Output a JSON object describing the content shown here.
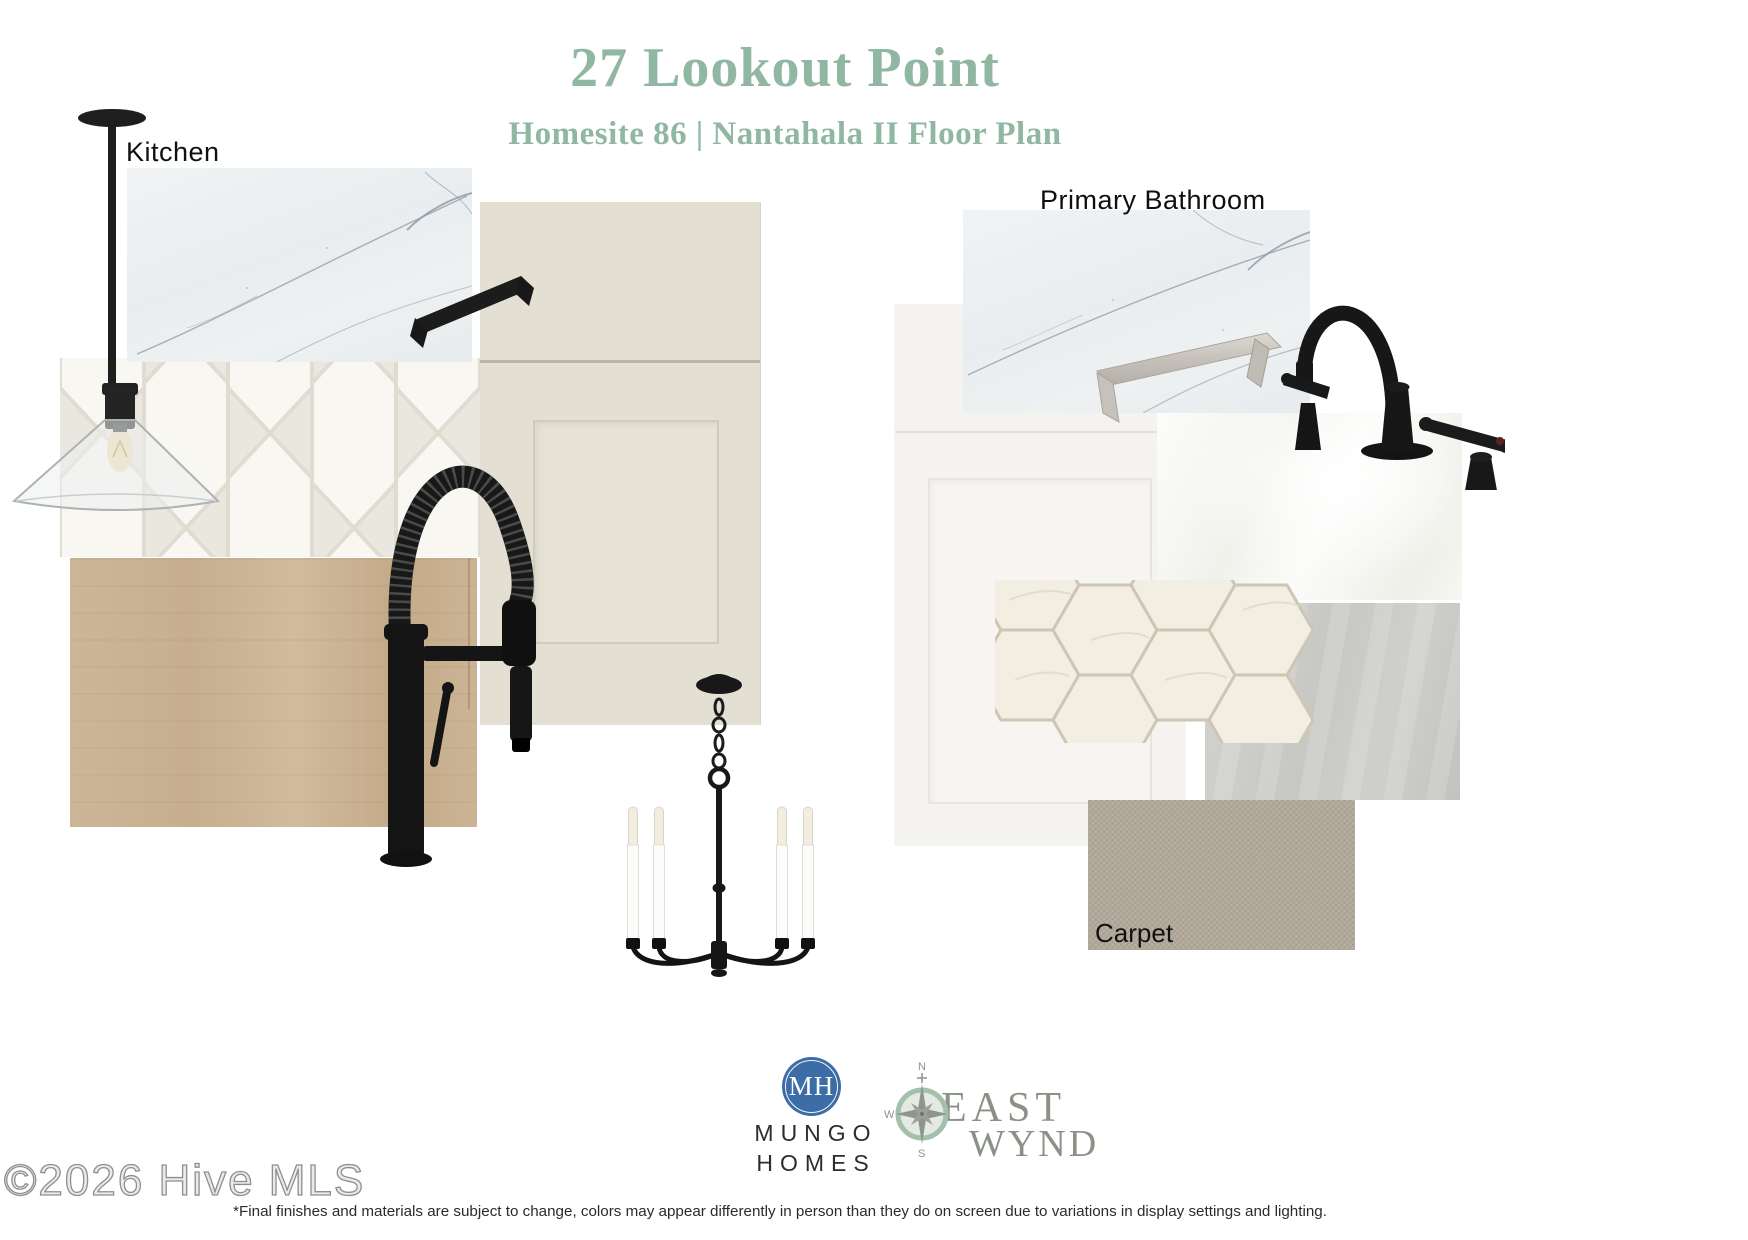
{
  "page": {
    "background": "#ffffff"
  },
  "header": {
    "title": "27 Lookout Point",
    "subtitle": "Homesite 86 | Nantahala II Floor Plan",
    "accent_color": "#90b7a1"
  },
  "kitchen": {
    "label": "Kitchen",
    "swatches": [
      "pendant-light",
      "quartz-countertop",
      "matte-black-cabinet-pull",
      "cream-shaker-cabinet-door",
      "picket-tile-backsplash",
      "light-oak-wood-flooring",
      "matte-black-spring-kitchen-faucet",
      "black-candle-chandelier"
    ]
  },
  "bathroom": {
    "label": "Primary Bathroom",
    "swatches": [
      "white-shaker-vanity-door",
      "brushed-nickel-cabinet-pull",
      "quartz-countertop",
      "glossy-white-wall-tile",
      "hexagon-marble-mosaic-tile",
      "grey-floor-tile",
      "matte-black-bathroom-faucet"
    ]
  },
  "carpet": {
    "label": "Carpet"
  },
  "footer": {
    "mungo_homes": {
      "monogram": "MH",
      "name_line1": "MUNGO",
      "name_line2": "HOMES",
      "brand_color": "#3d6da6"
    },
    "east_wynd": {
      "name_line1": "EAST",
      "name_line2": "WYND",
      "compass_n": "N",
      "compass_w": "W",
      "compass_s": "S",
      "brand_color": "#8b9187",
      "compass_ring_color": "#a4c0aa"
    },
    "disclaimer": "*Final finishes and materials are subject to change, colors may appear differently in person than they do on screen due to variations in display settings and lighting.",
    "watermark": "©2026 Hive MLS"
  }
}
